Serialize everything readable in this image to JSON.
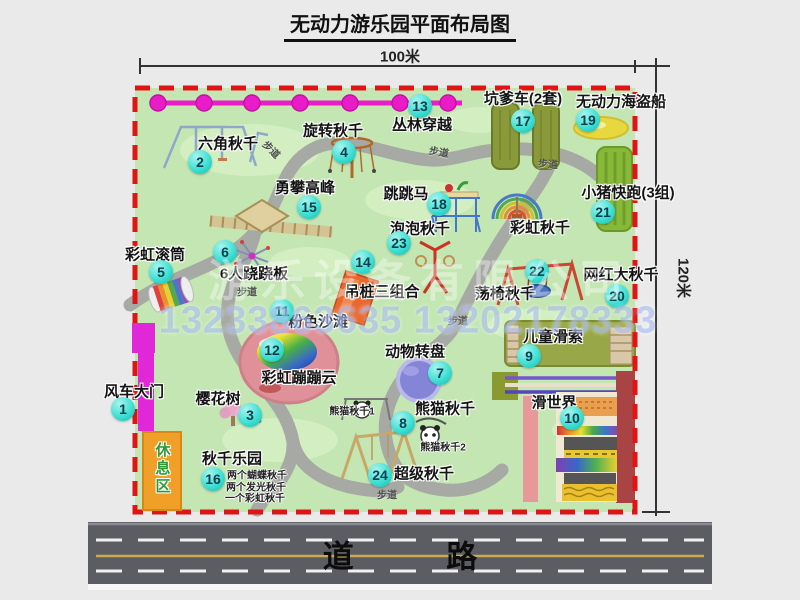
{
  "title": "无动力游乐园平面布局图",
  "dimensions": {
    "width_label": "100米",
    "height_label": "120米"
  },
  "road": {
    "label": "道 路"
  },
  "watermark": {
    "company": "游乐设备有限公司",
    "phones": "13233863635 13202178333"
  },
  "rest_area": {
    "label": "休息区"
  },
  "colors": {
    "map_green": "#c3e6b3",
    "border_red": "#e01414",
    "badge_teal": "#3fe0d4",
    "walkway_gray": "#a6a9a4",
    "chain_magenta": "#ea1cc8",
    "gate_magenta": "#e028d8",
    "road_gray": "#5c5c63",
    "rest_orange": "#f0a028"
  },
  "pois": [
    {
      "num": "1",
      "label": "风车大门",
      "label_x": 134,
      "label_y": 391,
      "badge_x": 123,
      "badge_y": 409
    },
    {
      "num": "2",
      "label": "六角秋千",
      "label_x": 228,
      "label_y": 143,
      "badge_x": 200,
      "badge_y": 162
    },
    {
      "num": "3",
      "label": "樱花树",
      "label_x": 218,
      "label_y": 398,
      "badge_x": 250,
      "badge_y": 415
    },
    {
      "num": "4",
      "label": "旋转秋千",
      "label_x": 333,
      "label_y": 130,
      "badge_x": 344,
      "badge_y": 152
    },
    {
      "num": "5",
      "label": "彩虹滚筒",
      "label_x": 155,
      "label_y": 254,
      "badge_x": 161,
      "badge_y": 272
    },
    {
      "num": "6",
      "label": "6人跷跷板",
      "label_x": 254,
      "label_y": 273,
      "badge_x": 225,
      "badge_y": 252
    },
    {
      "num": "7",
      "label": "动物转盘",
      "label_x": 415,
      "label_y": 351,
      "badge_x": 440,
      "badge_y": 373
    },
    {
      "num": "8",
      "label": "熊猫秋千",
      "label_x": 445,
      "label_y": 408,
      "badge_x": 403,
      "badge_y": 423,
      "subs": [
        {
          "text": "熊猫秋千1",
          "x": 352,
          "y": 410
        },
        {
          "text": "熊猫秋千2",
          "x": 443,
          "y": 446
        }
      ]
    },
    {
      "num": "9",
      "label": "儿童滑索",
      "label_x": 553,
      "label_y": 336,
      "badge_x": 529,
      "badge_y": 356
    },
    {
      "num": "10",
      "label": "滑世界",
      "label_x": 554,
      "label_y": 402,
      "badge_x": 572,
      "badge_y": 418
    },
    {
      "num": "11",
      "label": "粉色沙滩",
      "label_x": 318,
      "label_y": 321,
      "badge_x": 282,
      "badge_y": 311
    },
    {
      "num": "12",
      "label": "彩虹蹦蹦云",
      "label_x": 299,
      "label_y": 377,
      "badge_x": 272,
      "badge_y": 350
    },
    {
      "num": "13",
      "label": "丛林穿越",
      "label_x": 422,
      "label_y": 124,
      "badge_x": 420,
      "badge_y": 106
    },
    {
      "num": "14",
      "label": "吊桩三组合",
      "label_x": 382,
      "label_y": 291,
      "badge_x": 363,
      "badge_y": 262
    },
    {
      "num": "15",
      "label": "勇攀高峰",
      "label_x": 305,
      "label_y": 187,
      "badge_x": 309,
      "badge_y": 207
    },
    {
      "num": "16",
      "label": "秋千乐园",
      "label_x": 232,
      "label_y": 458,
      "badge_x": 213,
      "badge_y": 479,
      "subs": [
        {
          "text": "两个蝴蝶秋千",
          "x": 257,
          "y": 474
        },
        {
          "text": "两个发光秋千",
          "x": 256,
          "y": 486
        },
        {
          "text": "一个彩虹秋千",
          "x": 255,
          "y": 497
        }
      ]
    },
    {
      "num": "17",
      "label": "坑爹车(2套)",
      "label_x": 523,
      "label_y": 98,
      "badge_x": 523,
      "badge_y": 121
    },
    {
      "num": "18",
      "label": "跳跳马",
      "label_x": 406,
      "label_y": 193,
      "badge_x": 439,
      "badge_y": 204
    },
    {
      "num": "19",
      "label": "无动力海盗船",
      "label_x": 621,
      "label_y": 101,
      "badge_x": 588,
      "badge_y": 120
    },
    {
      "num": "20",
      "label": "网红大秋千",
      "label_x": 621,
      "label_y": 274,
      "badge_x": 617,
      "badge_y": 296
    },
    {
      "num": "21",
      "label": "小猪快跑(3组)",
      "label_x": 628,
      "label_y": 192,
      "badge_x": 603,
      "badge_y": 212
    },
    {
      "num": "22",
      "label": "荡椅秋千",
      "label_x": 505,
      "label_y": 293,
      "badge_x": 537,
      "badge_y": 271
    },
    {
      "num": "23",
      "label": "泡泡秋千",
      "label_x": 420,
      "label_y": 228,
      "badge_x": 399,
      "badge_y": 243
    },
    {
      "num": "24",
      "label": "超级秋千",
      "label_x": 424,
      "label_y": 473,
      "badge_x": 380,
      "badge_y": 475
    },
    {
      "num": "",
      "label": "彩虹秋千",
      "label_x": 540,
      "label_y": 227
    }
  ],
  "path_labels": [
    {
      "text": "步道",
      "x": 272,
      "y": 149,
      "rot": 45
    },
    {
      "text": "步道",
      "x": 439,
      "y": 151,
      "rot": 10
    },
    {
      "text": "步道",
      "x": 548,
      "y": 163,
      "rot": 5
    },
    {
      "text": "步道",
      "x": 247,
      "y": 291,
      "rot": 0
    },
    {
      "text": "步道",
      "x": 458,
      "y": 320,
      "rot": 0
    },
    {
      "text": "步道",
      "x": 256,
      "y": 414,
      "rot": 80
    },
    {
      "text": "步道",
      "x": 387,
      "y": 494,
      "rot": 0
    }
  ]
}
